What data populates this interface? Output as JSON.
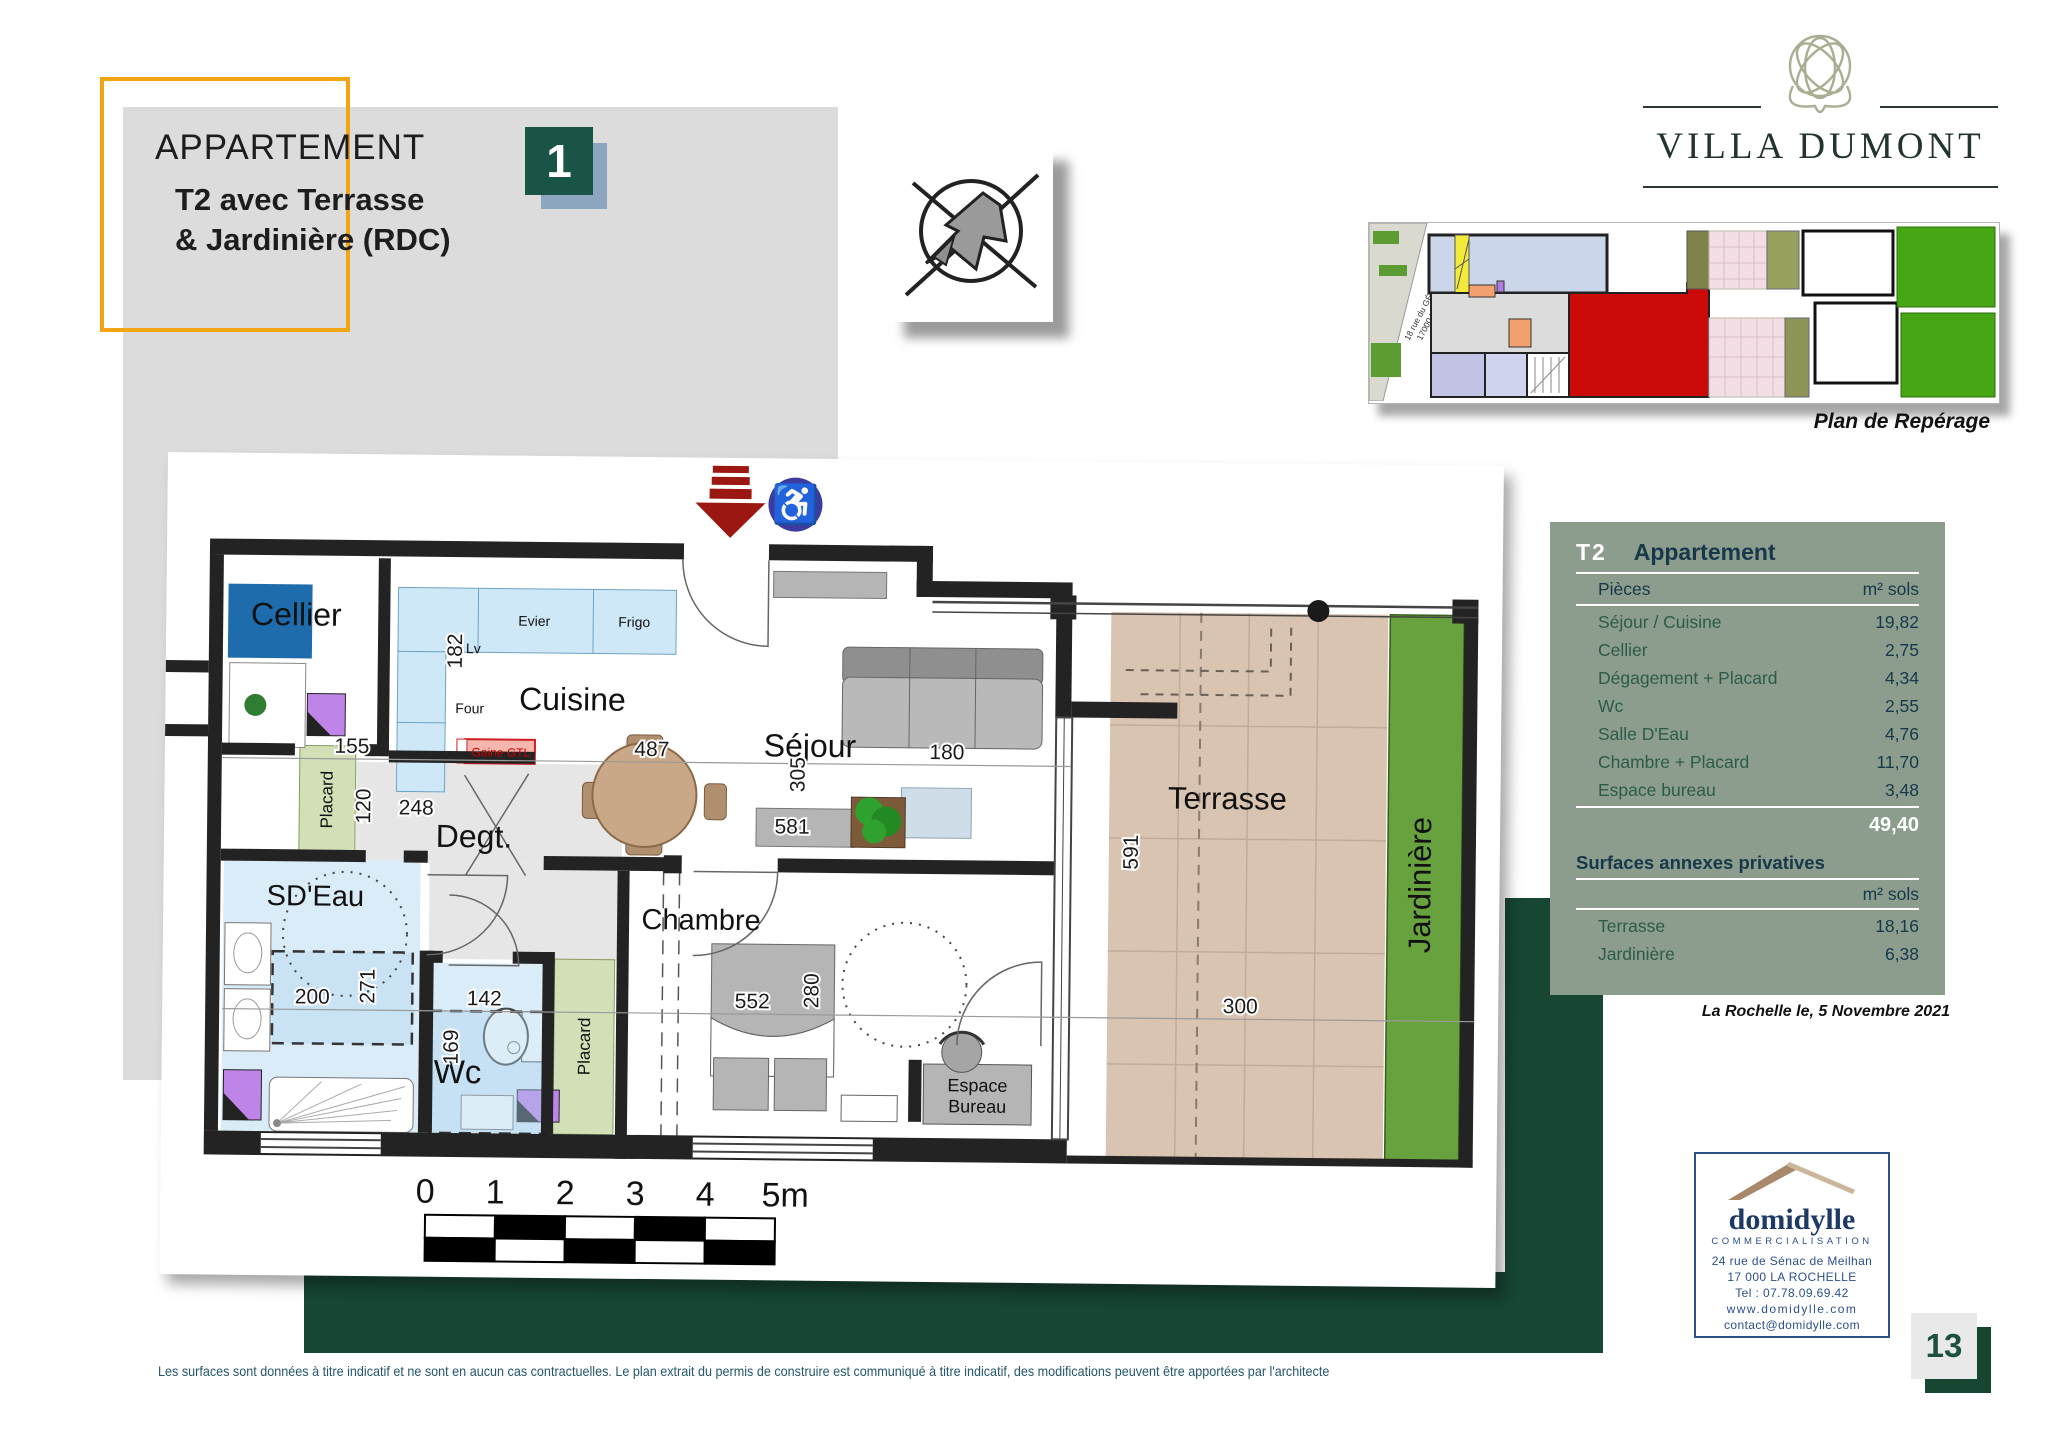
{
  "colors": {
    "accent_orange": "#f2a413",
    "dark_green_shape": "#174633",
    "badge_green": "#1a5446",
    "badge_shadow_blue": "#8ca6bf",
    "table_sage": "#8c9d8e",
    "table_navy_text": "#16384a",
    "table_green_text": "#2e5a49",
    "entry_arrow_red": "#9b1712",
    "handicap_blue": "#3c3c9e",
    "terrace_tan": "#d9c3b1",
    "jardiniere_green": "#68a23e",
    "site_unit_red": "#cc0a0a",
    "agency_navy": "#2d4f8a"
  },
  "header": {
    "title_line1": "APPARTEMENT",
    "title_line2": "T2 avec Terrasse",
    "title_line3": "& Jardinière (RDC)",
    "badge": "1"
  },
  "brand": {
    "name": "VILLA DUMONT"
  },
  "site_plan": {
    "street_line1": "18 rue du GÉNÉRAL DUMONT",
    "street_line2": "17000 LA ROCHELLE",
    "caption": "Plan de Repérage"
  },
  "plan": {
    "rooms": {
      "cellier": "Cellier",
      "cuisine": "Cuisine",
      "sejour": "Séjour",
      "degt": "Degt.",
      "sdeau": "SD'Eau",
      "wc": "Wc",
      "chambre": "Chambre",
      "espace_l1": "Espace",
      "espace_l2": "Bureau",
      "terrasse": "Terrasse",
      "jardiniere": "Jardinière",
      "placard": "Placard"
    },
    "kitchen": {
      "evier": "Evier",
      "frigo": "Frigo",
      "lv": "Lv",
      "four": "Four",
      "gaine": "Gaine GTL"
    },
    "dims": {
      "d155": "155",
      "d182": "182",
      "d487": "487",
      "d180": "180",
      "d305": "305",
      "d581": "581",
      "d120": "120",
      "d248": "248",
      "d200": "200",
      "d271": "271",
      "d142": "142",
      "d169": "169",
      "d552": "552",
      "d280": "280",
      "d591": "591",
      "d300": "300"
    },
    "scale": {
      "s0": "0",
      "s1": "1",
      "s2": "2",
      "s3": "3",
      "s4": "4",
      "s5": "5m"
    }
  },
  "table": {
    "type_badge": "T2",
    "title": "Appartement",
    "col_rooms": "Pièces",
    "col_area": "m² sols",
    "rows": [
      {
        "label": "Séjour / Cuisine",
        "value": "19,82"
      },
      {
        "label": "Cellier",
        "value": "2,75"
      },
      {
        "label": "Dégagement + Placard",
        "value": "4,34"
      },
      {
        "label": "Wc",
        "value": "2,55"
      },
      {
        "label": "Salle D'Eau",
        "value": "4,76"
      },
      {
        "label": "Chambre  + Placard",
        "value": "11,70"
      },
      {
        "label": "Espace bureau",
        "value": "3,48"
      }
    ],
    "total": "49,40",
    "annex_title": "Surfaces annexes privatives",
    "annex_col_area": "m² sols",
    "annex_rows": [
      {
        "label": "Terrasse",
        "value": "18,16"
      },
      {
        "label": "Jardinière",
        "value": "6,38"
      }
    ],
    "date_note": "La Rochelle  le, 5 Novembre 2021"
  },
  "agency": {
    "name": "domidylle",
    "tagline": "COMMERCIALISATION",
    "address_line1": "24  rue de Sénac de Meilhan",
    "address_line2": "17 000    LA    ROCHELLE",
    "phone": "Tel :  07.78.09.69.42",
    "website": "www.domidylle.com",
    "email": "contact@domidylle.com"
  },
  "page": {
    "number": "13",
    "disclaimer": "Les  surfaces  sont  données à  titre  indicatif et ne sont en  aucun  cas  contractuelles. Le plan extrait  du permis de  construire est  communiqué à  titre indicatif, des  modifications peuvent être apportées par l'architecte"
  }
}
